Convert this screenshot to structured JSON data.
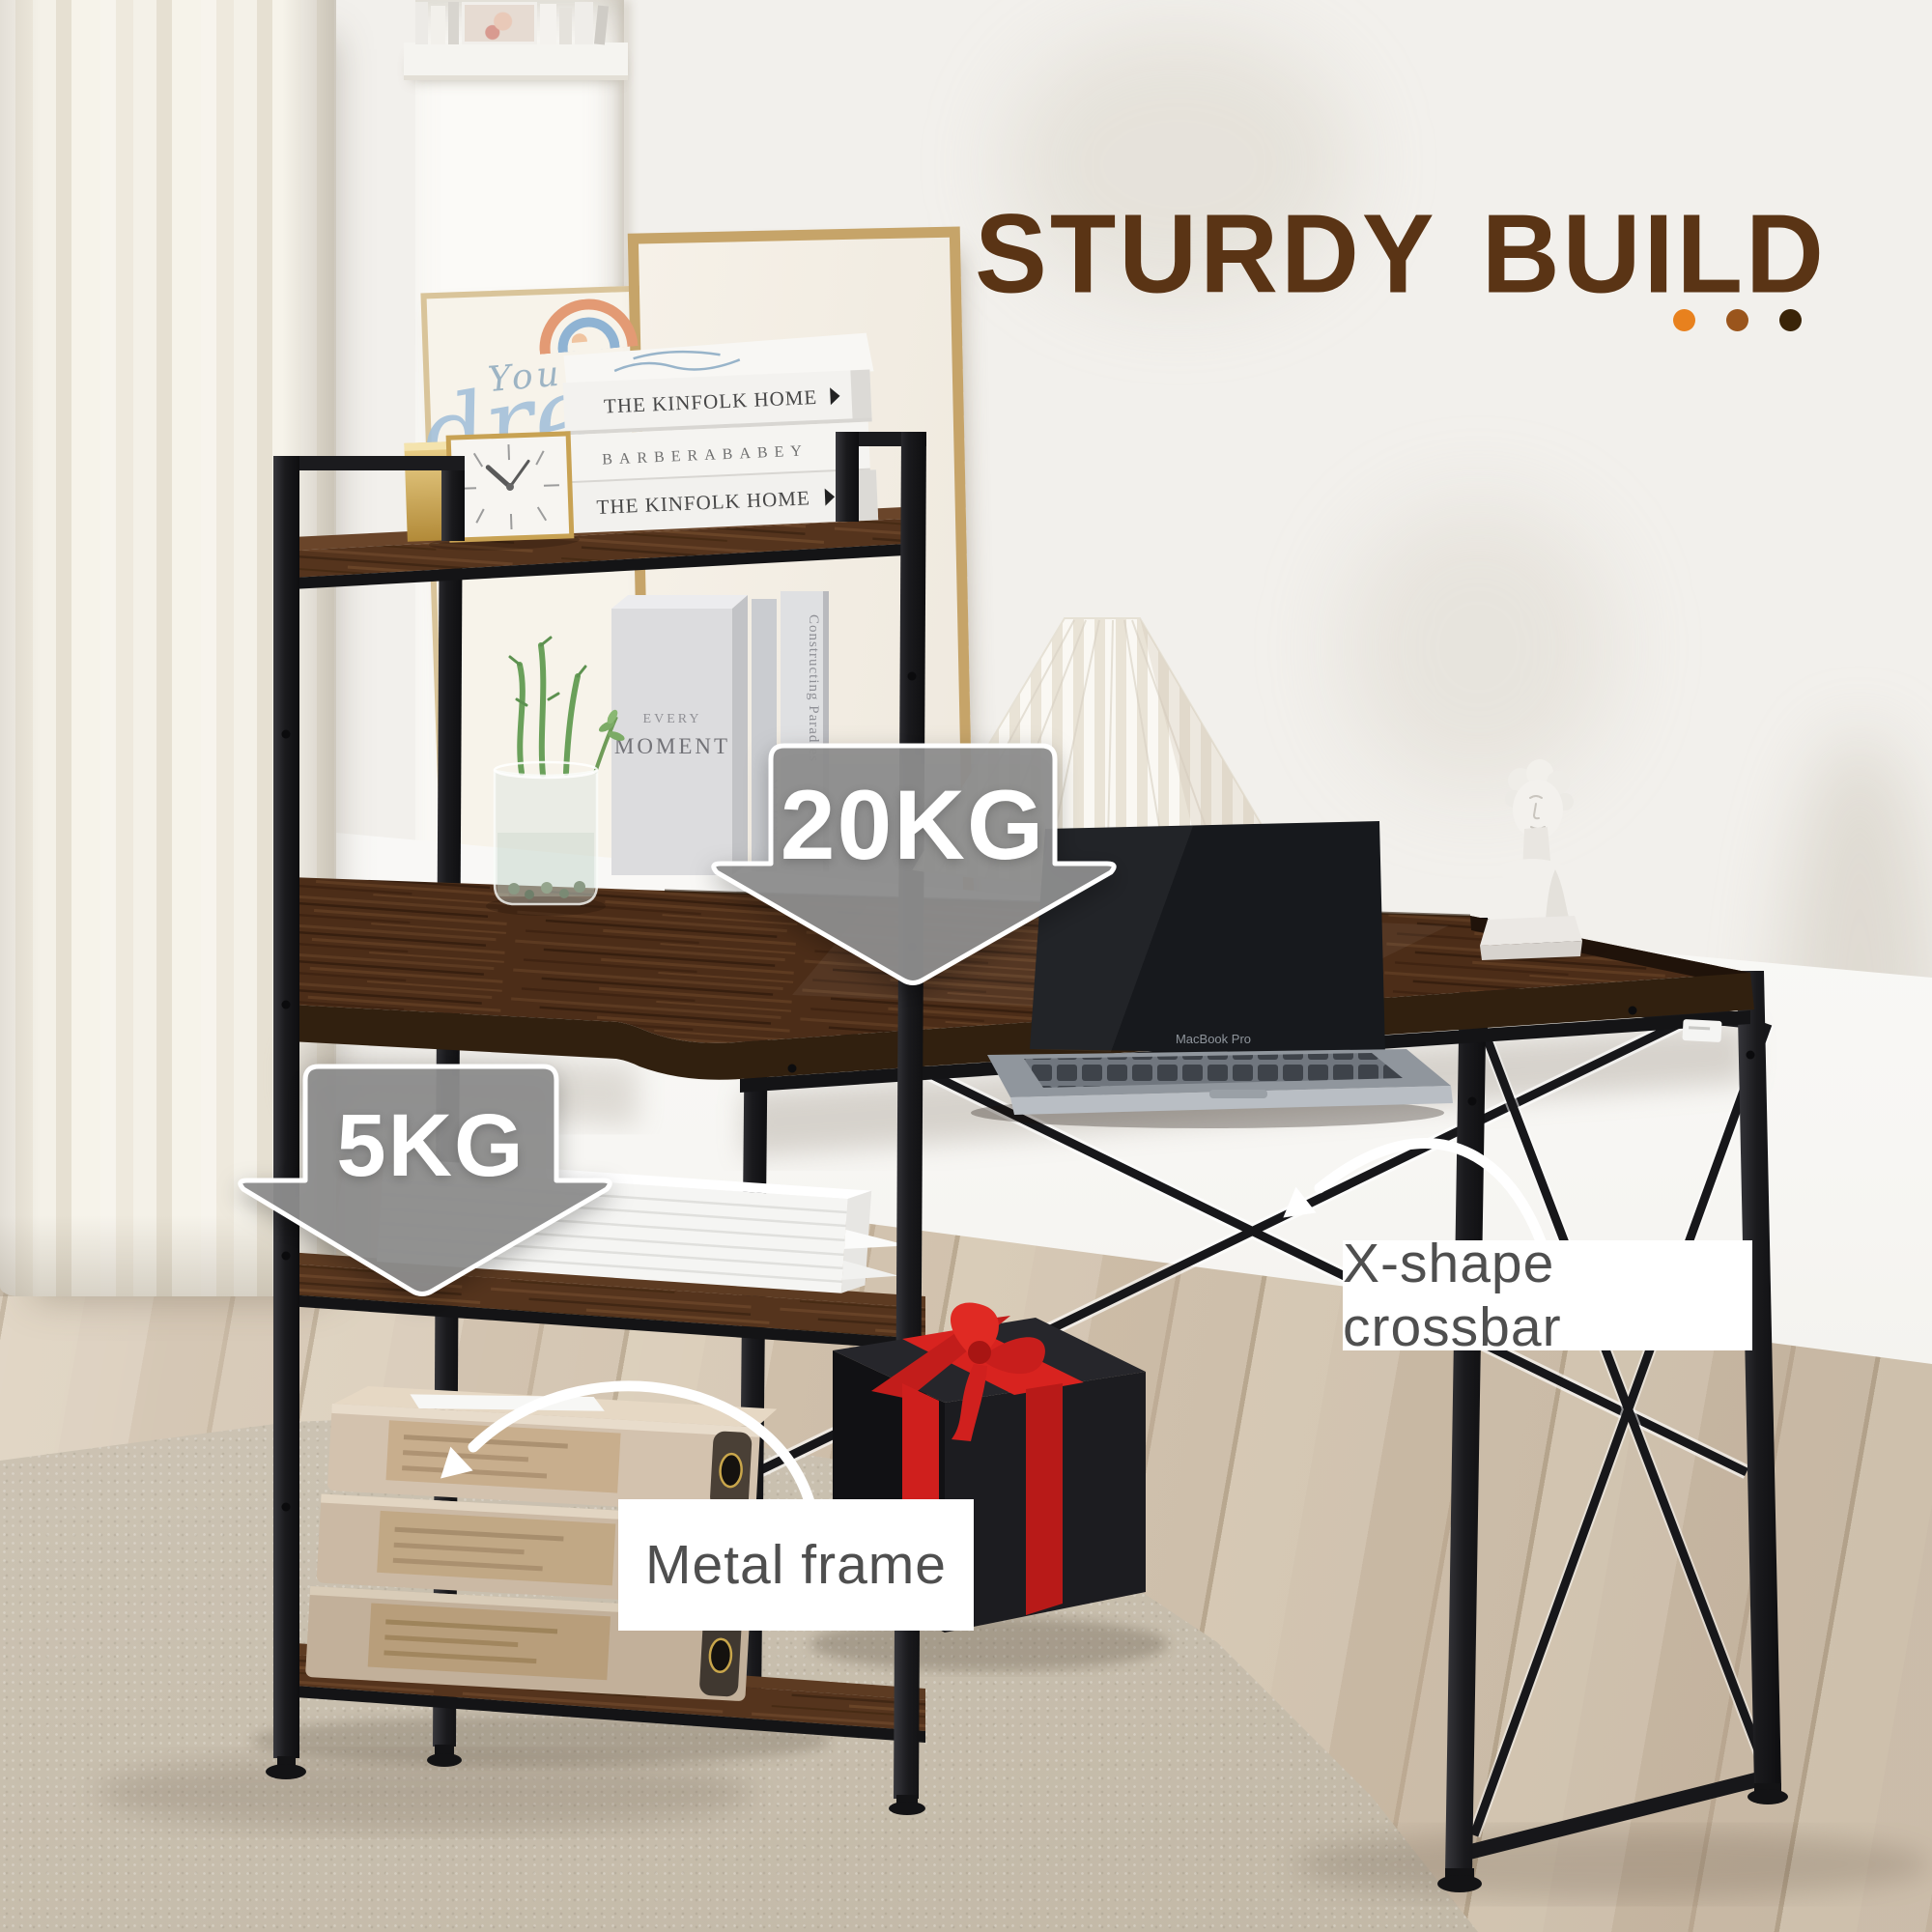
{
  "header": {
    "title": "STURDY BUILD",
    "title_color": "#5a3415",
    "accent_dots": [
      "#e8811e",
      "#9a551c",
      "#3a2408"
    ]
  },
  "callouts": {
    "desk_capacity": "20KG",
    "shelf_capacity": "5KG",
    "crossbar_label": "X-shape crossbar",
    "frame_label": "Metal frame",
    "arrow_fill": "#8d8d8d",
    "label_text_color": "#4f4f4f"
  },
  "decor": {
    "art_script_line1": "You got",
    "art_script_line2": "dre",
    "top_shelf_books": {
      "book1": "THE KINFOLK HOME",
      "book2": "BARBERABABEY",
      "book3": "THE KINFOLK HOME"
    },
    "middle_shelf": {
      "box_small": "EVERY",
      "box_large": "MOMENT",
      "spine_vertical1": "Constructing Paradies",
      "spine_vertical2": "MOMENT"
    },
    "laptop_text": "MacBook Pro"
  },
  "materials": {
    "wood": "#4c2d18",
    "metal": "#1b1b1d",
    "ribbon_red": "#d8231f",
    "rug": "#cfc7b9",
    "floor": "#d0c1ac"
  }
}
